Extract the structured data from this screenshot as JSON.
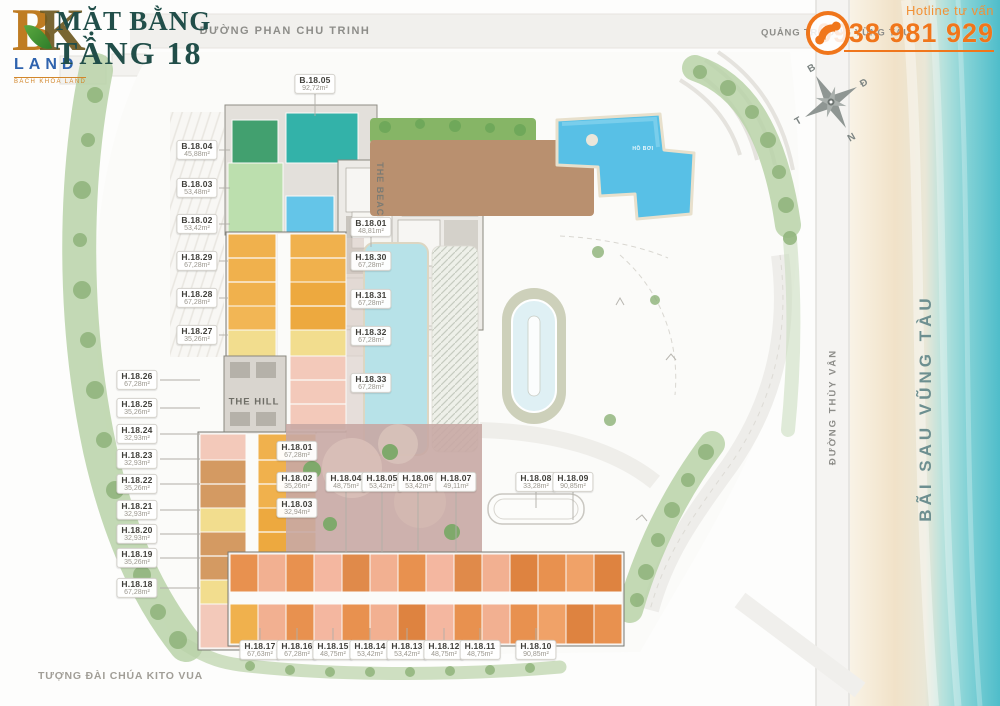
{
  "branding": {
    "logo_b": "B",
    "logo_k": "K",
    "logo_land": "LAND",
    "logo_sub": "BÁCH KHOA LAND"
  },
  "title": {
    "line1": "MẶT BẰNG",
    "line2": "TẦNG 18"
  },
  "hotline": {
    "label": "Hotline tư vấn",
    "number": "0938 981 929"
  },
  "streets": {
    "phan_chu_trinh": "ĐƯỜNG PHAN CHU TRINH",
    "quang_truong": "QUẢNG TRƯỜNG VŨNG TÀU",
    "thuy_van": "ĐƯỜNG THÙY VÂN",
    "bai_sau": "BÃI SAU VŨNG TÀU",
    "landmark": "TƯỢNG ĐÀI CHÚA KITO VUA"
  },
  "compass": {
    "n": "B",
    "e": "Đ",
    "s": "N",
    "w": "T"
  },
  "zones": {
    "hill": "THE HILL",
    "beach": "THE BEACH",
    "pool": "HỒ BƠI"
  },
  "units": {
    "top": {
      "id": "B.18.05",
      "area": "92,72m²"
    },
    "center": {
      "id": "B.18.01",
      "area": "48,81m²"
    },
    "left_inner": [
      {
        "id": "B.18.04",
        "area": "45,88m²"
      },
      {
        "id": "B.18.03",
        "area": "53,48m²"
      },
      {
        "id": "B.18.02",
        "area": "53,42m²"
      },
      {
        "id": "H.18.29",
        "area": "67,28m²"
      },
      {
        "id": "H.18.28",
        "area": "67,28m²"
      },
      {
        "id": "H.18.27",
        "area": "35,26m²"
      }
    ],
    "left_outer": [
      {
        "id": "H.18.26",
        "area": "67,28m²"
      },
      {
        "id": "H.18.25",
        "area": "35,26m²"
      },
      {
        "id": "H.18.24",
        "area": "32,93m²"
      },
      {
        "id": "H.18.23",
        "area": "32,93m²"
      },
      {
        "id": "H.18.22",
        "area": "35,26m²"
      },
      {
        "id": "H.18.21",
        "area": "32,93m²"
      },
      {
        "id": "H.18.20",
        "area": "32,93m²"
      },
      {
        "id": "H.18.19",
        "area": "35,26m²"
      },
      {
        "id": "H.18.18",
        "area": "67,28m²"
      }
    ],
    "mid_column": [
      {
        "id": "H.18.30",
        "area": "67,28m²"
      },
      {
        "id": "H.18.31",
        "area": "67,28m²"
      },
      {
        "id": "H.18.32",
        "area": "67,28m²"
      },
      {
        "id": "H.18.33",
        "area": "67,28m²"
      }
    ],
    "center_row": [
      {
        "id": "H.18.01",
        "area": "67,28m²"
      },
      {
        "id": "H.18.02",
        "area": "35,26m²"
      },
      {
        "id": "H.18.03",
        "area": "32,94m²"
      },
      {
        "id": "H.18.04",
        "area": "48,75m²"
      },
      {
        "id": "H.18.05",
        "area": "53,42m²"
      },
      {
        "id": "H.18.06",
        "area": "53,42m²"
      },
      {
        "id": "H.18.07",
        "area": "49,11m²"
      },
      {
        "id": "H.18.08",
        "area": "33,28m²"
      },
      {
        "id": "H.18.09",
        "area": "90,85m²"
      }
    ],
    "bottom_row": [
      {
        "id": "H.18.17",
        "area": "67,63m²"
      },
      {
        "id": "H.18.16",
        "area": "67,28m²"
      },
      {
        "id": "H.18.15",
        "area": "48,75m²"
      },
      {
        "id": "H.18.14",
        "area": "53,42m²"
      },
      {
        "id": "H.18.13",
        "area": "53,42m²"
      },
      {
        "id": "H.18.12",
        "area": "48,75m²"
      },
      {
        "id": "H.18.11",
        "area": "48,75m²"
      },
      {
        "id": "H.18.10",
        "area": "90,85m²"
      }
    ]
  },
  "colors": {
    "accent": "#F0761B",
    "title": "#214E49",
    "land_blue": "#2F63AE",
    "pool": "#58C0E6",
    "teal_unit": "#33B2A9",
    "gold_unit": "#F0B14D",
    "salmon_unit": "#F2B091",
    "pink_unit": "#F3C9BA",
    "tree_green": "#8CB177",
    "deck_brown": "#B9906F"
  }
}
